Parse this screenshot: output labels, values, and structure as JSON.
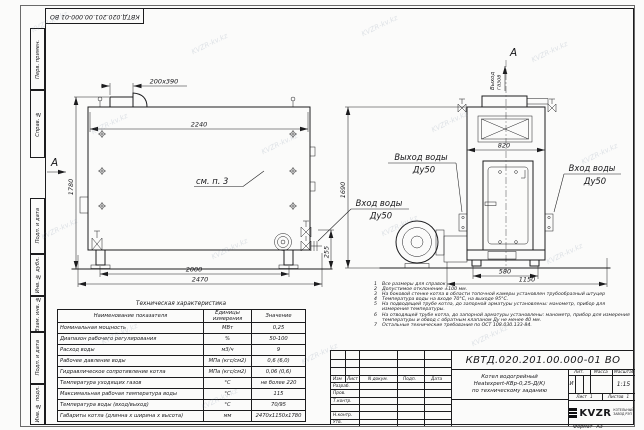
{
  "watermark": {
    "text": "KVZR-kv.kz"
  },
  "stamp": {
    "doc_number": "КВТД.020.201.00.000-01 ВО"
  },
  "margin": {
    "labels": [
      "Перв. примен.",
      "Справ. №",
      "Подп. и дата",
      "Инв. № дубл.",
      "Взам. инв. №",
      "Подп. и дата",
      "Инв. № подл."
    ]
  },
  "front": {
    "section_mark": "А",
    "see_note": "см. п. 3",
    "dim_duct": "200х390",
    "dim_width": "2240",
    "dim_height": "1780",
    "dim_legs": "2000",
    "dim_overall": "2470",
    "dim_pipe_height": "255",
    "inlet_label_1": "Вход воды",
    "inlet_label_2": "Ду50"
  },
  "side": {
    "view_mark": "А",
    "gas_outlet_1": "Выход",
    "gas_outlet_2": "газов",
    "dim_width": "820",
    "dim_height": "1690",
    "dim_base": "580",
    "dim_overall": "1150",
    "outlet_label_1": "Выход воды",
    "outlet_label_2": "Ду50",
    "inlet_label_1": "Вход воды",
    "inlet_label_2": "Ду50"
  },
  "notes": {
    "items": [
      {
        "num": "1",
        "text": "Все размеры для справок"
      },
      {
        "num": "2",
        "text": "Допустимое отклонение ±100 мм."
      },
      {
        "num": "3",
        "text": "На боковой стенке котла в области топочной камеры установлен трубообразный штуцер"
      },
      {
        "num": "4",
        "text": "Температура воды на входе 70°С, на выходе 95°С."
      },
      {
        "num": "5",
        "text": "На подводящей трубе котла, до запорной арматуры установлены: манометр, прибор для измерения температуры."
      },
      {
        "num": "6",
        "text": "На отводящей трубе котла, до запорной арматуры установлены: манометр, прибор для измерения температуры и обвод с обратным клапаном Ду не менее 40 мм."
      },
      {
        "num": "7",
        "text": "Остальные технические требования по ОСТ 108.030.133-84."
      }
    ]
  },
  "tech": {
    "title": "Техническая характеристика",
    "col_name": "Наименование показателя",
    "col_units_1": "Единицы",
    "col_units_2": "измерения",
    "col_value": "Значение",
    "rows": [
      {
        "name": "Номинальная мощность",
        "units": "МВт",
        "value": "0,25"
      },
      {
        "name": "Диапазон рабочего регулирования",
        "units": "%",
        "value": "50-100"
      },
      {
        "name": "Расход воды",
        "units": "м3/ч",
        "value": "9"
      },
      {
        "name": "Рабочее давление воды",
        "units": "МПа (кгс/см2)",
        "value": "0,6 (6,0)"
      },
      {
        "name": "Гидравлическое сопротивление котла",
        "units": "МПа (кгс/см2)",
        "value": "0,06 (0,6)"
      },
      {
        "name": "Температура уходящих газов",
        "units": "°С",
        "value": "не более 220"
      },
      {
        "name": "Максимальная рабочая температура воды",
        "units": "°С",
        "value": "115"
      },
      {
        "name": "Температура воды (вход/выход)",
        "units": "°С",
        "value": "70/95"
      },
      {
        "name": "Габариты котла (длинна х ширина х высота)",
        "units": "мм",
        "value": "2470х1150х1780"
      }
    ]
  },
  "titleblock": {
    "doc_number": "КВТД.020.201.00.000-01 ВО",
    "name_line1": "Котел водогрейный",
    "name_line2": "Heatexpert-КВр-0,25-Д(К)",
    "name_line3": "по техническому заданию",
    "col_izm": "Изм",
    "col_list": "Лист",
    "col_doc": "N докум.",
    "col_sign": "Подп.",
    "col_date": "Дата",
    "row_developed": "Разраб.",
    "row_checked": "Пров.",
    "row_tcontrol": "Т.контр.",
    "row_ncontrol": "Н.контр.",
    "row_approved": "Утв.",
    "lit_header": "Лит.",
    "mass_header": "Масса",
    "scale_header": "Масштаб",
    "lit_value": "И",
    "scale_value": "1:15",
    "sheet_label": "Лист",
    "sheet_value": "1",
    "sheets_label": "Листов",
    "sheets_value": "1",
    "logo_text": "KVZR",
    "logo_sub1": "КОТЕЛЬНЫЙ",
    "logo_sub2": "ЗАВОД РЭП",
    "format_label": "Формат",
    "format_value": "А3"
  }
}
